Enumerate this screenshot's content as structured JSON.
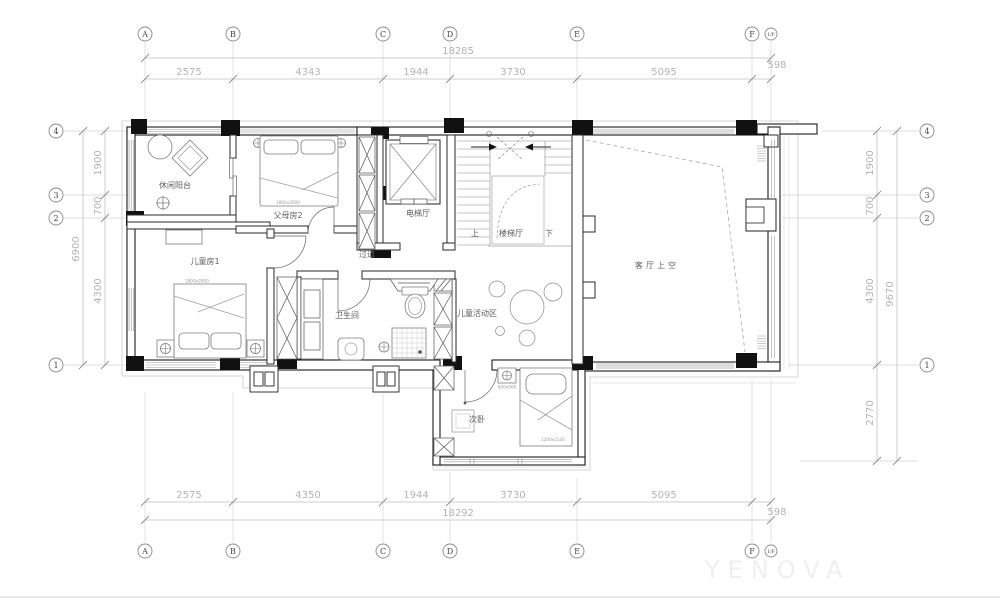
{
  "drawing": {
    "watermark": "YENOVA",
    "grid": {
      "cols": [
        "A",
        "B",
        "C",
        "D",
        "E",
        "F",
        "1/F"
      ],
      "rows": [
        "4",
        "3",
        "2",
        "1"
      ]
    },
    "dims": {
      "top": {
        "overall": "18285",
        "seg": [
          "2575",
          "4343",
          "1944",
          "3730",
          "5095",
          "598"
        ]
      },
      "bottom": {
        "overall": "18292",
        "seg": [
          "2575",
          "4350",
          "1944",
          "3730",
          "5095",
          "598"
        ]
      },
      "left": {
        "overall": "6900",
        "seg": [
          "1900",
          "700",
          "4300"
        ]
      },
      "right": {
        "overall": "9670",
        "seg": [
          "1900",
          "700",
          "4300",
          "2770"
        ]
      }
    },
    "rooms": {
      "balcony": "休闲阳台",
      "parents": "父母房2",
      "elevator": "电梯厅",
      "stair": "楼梯厅",
      "up": "上",
      "down": "下",
      "living": "客厅上空",
      "kids": "儿童房1",
      "corridor": "过道",
      "bath": "卫生间",
      "play": "儿童活动区",
      "second": "次卧"
    },
    "furniture": {
      "bed_parents": "1800x2000",
      "bed_kids": "1800x2000",
      "bed_second": "1200x2130",
      "stand_second": "600x600"
    }
  }
}
